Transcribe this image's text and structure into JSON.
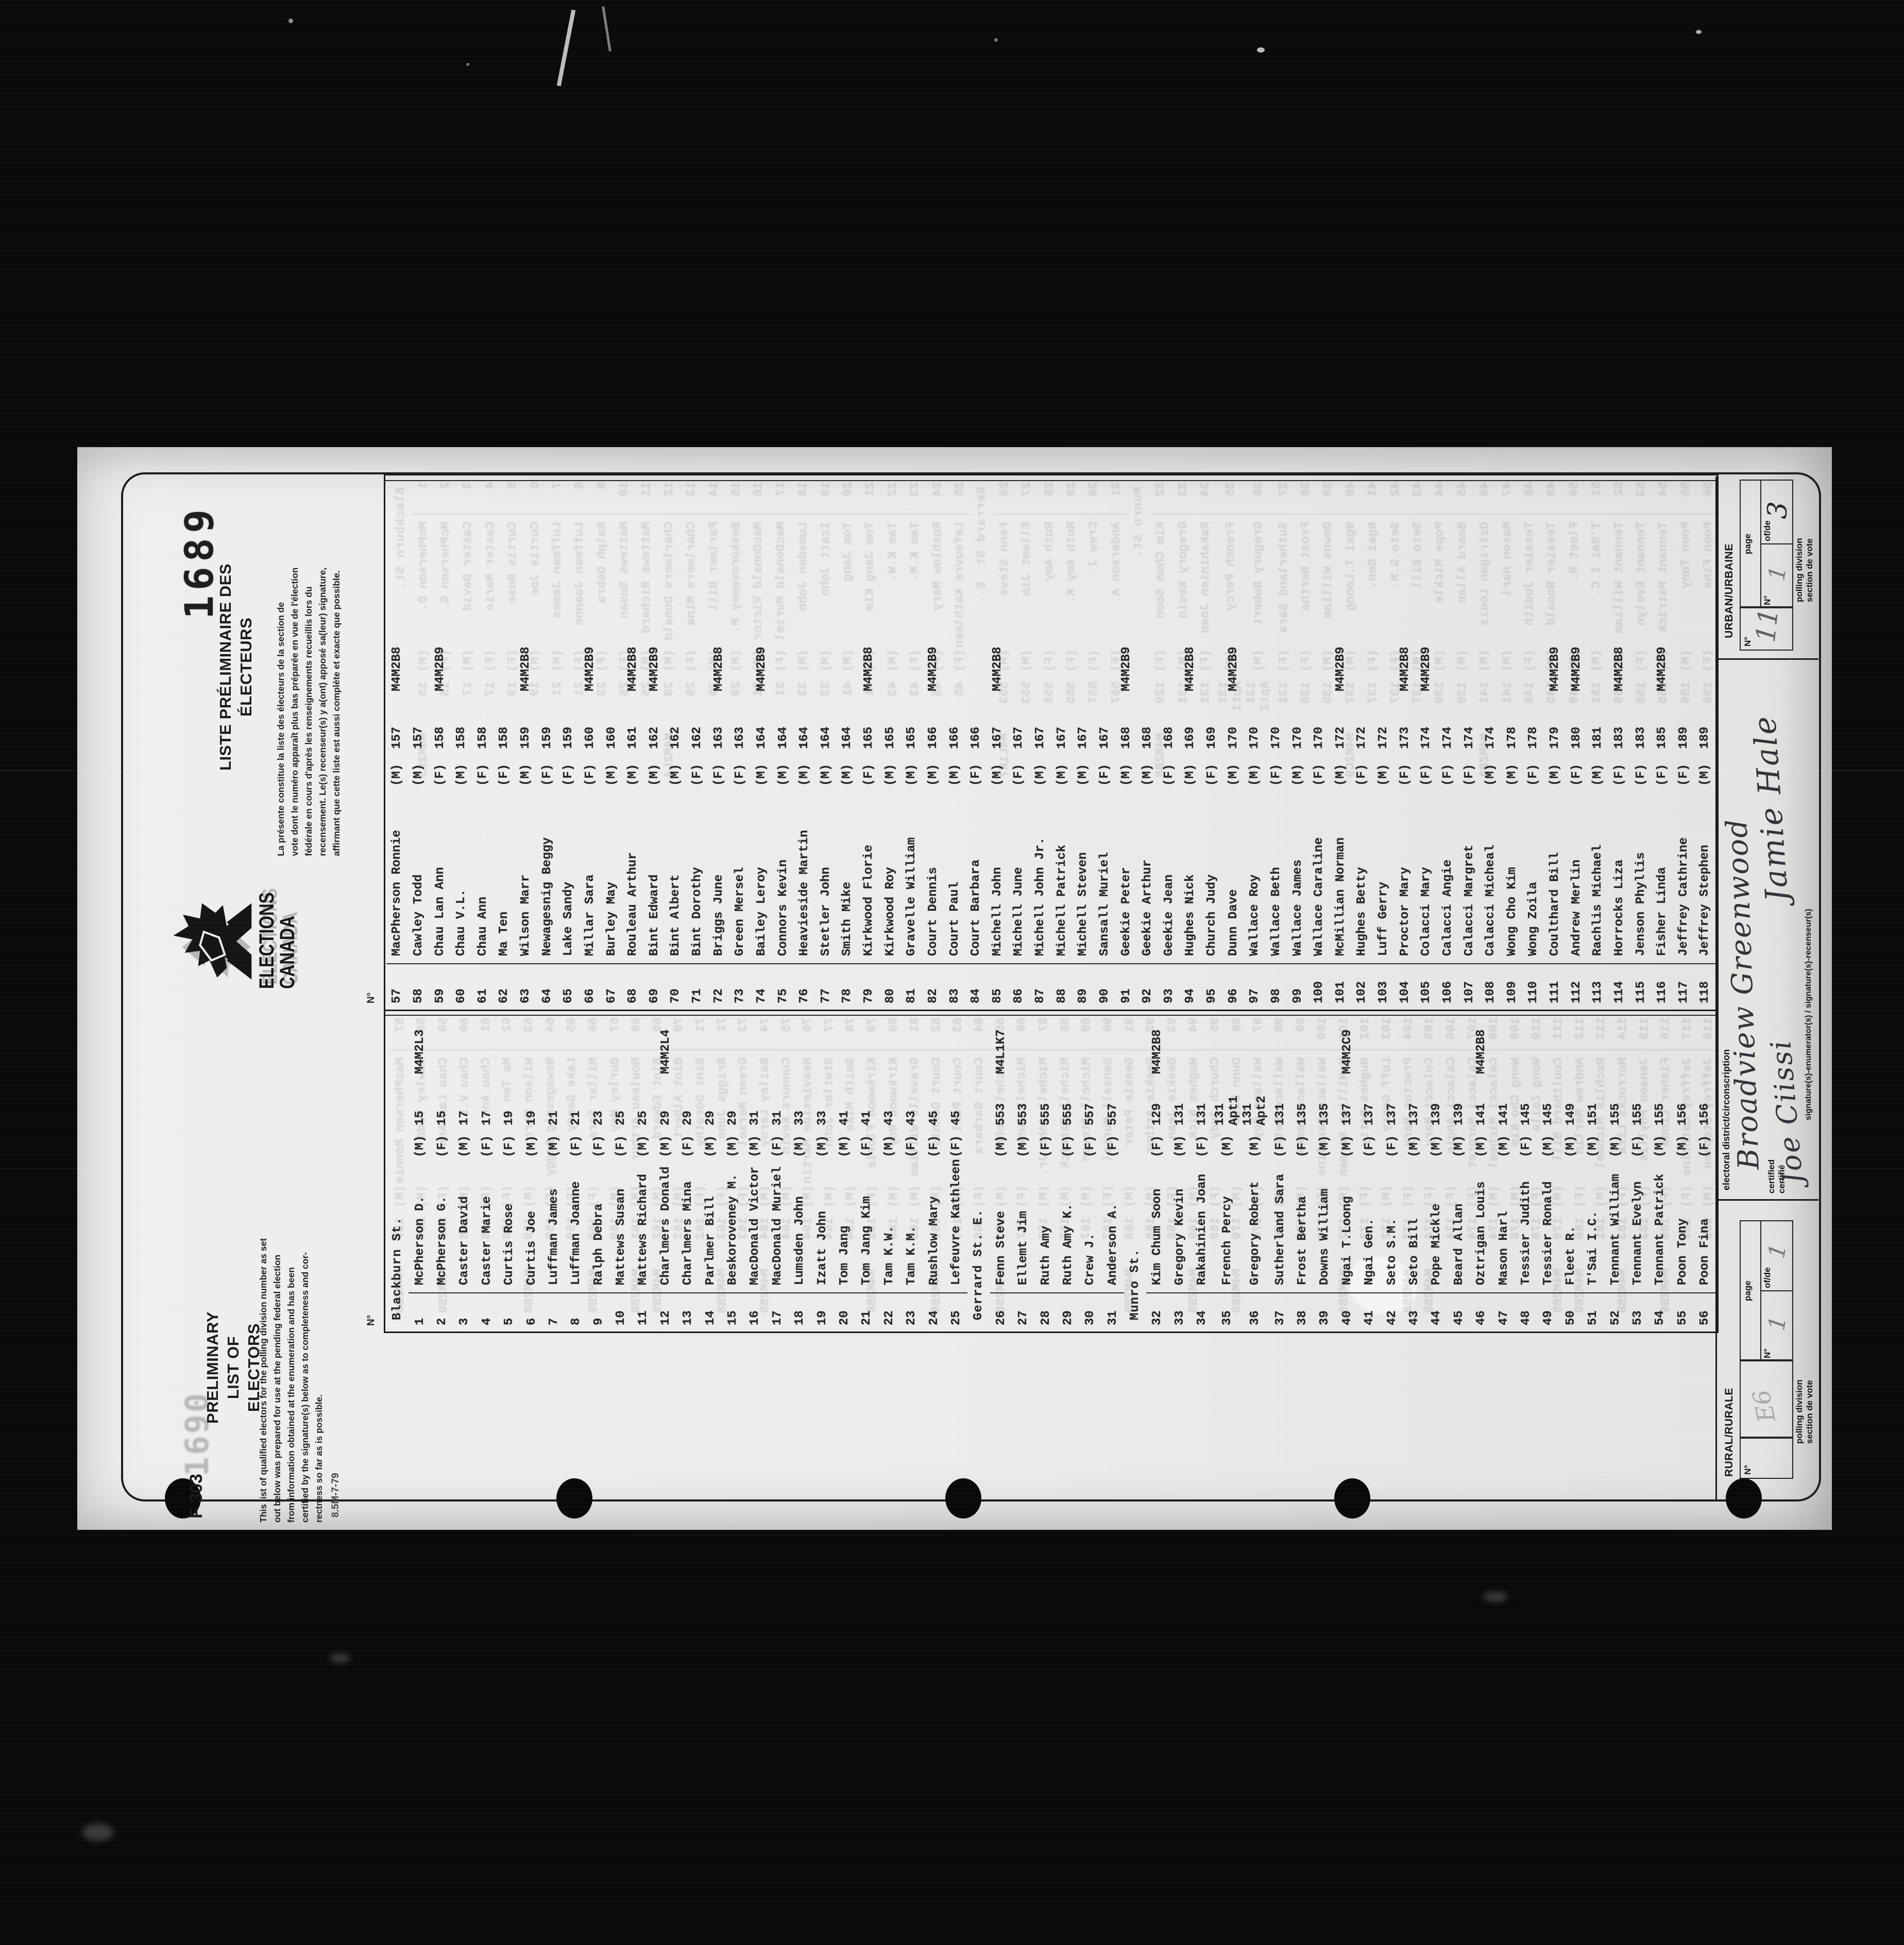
{
  "film": {
    "stamp_bold": "1689",
    "stamp_faint": "1690"
  },
  "header": {
    "form_number": "F 303",
    "print_code": "8.5M-7-79",
    "title_en_l1": "PRELIMINARY LIST OF",
    "title_en_l2": "ELECTORS",
    "paragraph_en": [
      "This list of qualified electors for the polling division number as set",
      "out below was prepared for use at the pending federal election",
      "from information obtained at the enumeration and has been",
      "certified by the signature(s) below as to completeness and cor-",
      "rectness so far as is possible."
    ],
    "logo_line1": "ELECTIONS",
    "logo_line2": "CANADA",
    "title_fr_l1": "LISTE PRÉLIMINAIRE DES",
    "title_fr_l2": "ÉLECTEURS",
    "paragraph_fr": [
      "La présente constitue la liste des électeurs de la section de",
      "vote dont le numéro apparaît plus bas préparée en vue de l'élection",
      "fédérale en cours d'après les renseignements recueillis lors du",
      "recensement. Le(s) recenseur(s) y a(ont) apposé sa(leur) signature,",
      "affirmant que cette liste est aussi complète et exacte que possible."
    ]
  },
  "table": {
    "no_header": "N°",
    "left": [
      {
        "street": "Blackburn St."
      },
      {
        "no": "1",
        "name": "McPherson D.",
        "mf": "(M)",
        "addr": "15",
        "pc": "M4M2L3"
      },
      {
        "no": "2",
        "name": "McPherson G.",
        "mf": "(F)",
        "addr": "15",
        "pc": ""
      },
      {
        "no": "3",
        "name": "Caster David",
        "mf": "(M)",
        "addr": "17",
        "pc": ""
      },
      {
        "no": "4",
        "name": "Caster Marie",
        "mf": "(F)",
        "addr": "17",
        "pc": ""
      },
      {
        "no": "5",
        "name": "Curtis Rose",
        "mf": "(F)",
        "addr": "19",
        "pc": ""
      },
      {
        "no": "6",
        "name": "Curtis Joe",
        "mf": "(M)",
        "addr": "19",
        "pc": ""
      },
      {
        "no": "7",
        "name": "Luffman James",
        "mf": "(M)",
        "addr": "21",
        "pc": ""
      },
      {
        "no": "8",
        "name": "Luffman Joanne",
        "mf": "(F)",
        "addr": "21",
        "pc": ""
      },
      {
        "no": "9",
        "name": "Ralph Debra",
        "mf": "(F)",
        "addr": "23",
        "pc": ""
      },
      {
        "no": "10",
        "name": "Mattews Susan",
        "mf": "(F)",
        "addr": "25",
        "pc": ""
      },
      {
        "no": "11",
        "name": "Mattews Richard",
        "mf": "(M)",
        "addr": "25",
        "pc": ""
      },
      {
        "no": "12",
        "name": "Charlmers Donald",
        "mf": "(M)",
        "addr": "29",
        "pc": "M4M2L4"
      },
      {
        "no": "13",
        "name": "Charlmers Mina",
        "mf": "(F)",
        "addr": "29",
        "pc": ""
      },
      {
        "no": "14",
        "name": "Parlmer Bill",
        "mf": "(M)",
        "addr": "29",
        "pc": ""
      },
      {
        "no": "15",
        "name": "Beskoroveney M.",
        "mf": "(M)",
        "addr": "29",
        "pc": ""
      },
      {
        "no": "16",
        "name": "MacDonald Victor",
        "mf": "(M)",
        "addr": "31",
        "pc": ""
      },
      {
        "no": "17",
        "name": "MacDonald Muriel",
        "mf": "(F)",
        "addr": "31",
        "pc": ""
      },
      {
        "no": "18",
        "name": "Lumsden John",
        "mf": "(M)",
        "addr": "33",
        "pc": ""
      },
      {
        "no": "19",
        "name": "Izatt John",
        "mf": "(M)",
        "addr": "33",
        "pc": ""
      },
      {
        "no": "20",
        "name": "Tom Jang",
        "mf": "(M)",
        "addr": "41",
        "pc": ""
      },
      {
        "no": "21",
        "name": "Tom Jang Kim",
        "mf": "(F)",
        "addr": "41",
        "pc": ""
      },
      {
        "no": "22",
        "name": "Tam K.W.",
        "mf": "(M)",
        "addr": "43",
        "pc": ""
      },
      {
        "no": "23",
        "name": "Tam K.M.",
        "mf": "(F)",
        "addr": "43",
        "pc": ""
      },
      {
        "no": "24",
        "name": "Rushlow Mary",
        "mf": "(F)",
        "addr": "45",
        "pc": ""
      },
      {
        "no": "25",
        "name": "Lefeuvre Kathleen",
        "mf": "(F)",
        "addr": "45",
        "pc": ""
      },
      {
        "street": "Gerrard St. E."
      },
      {
        "no": "26",
        "name": "Fenn Steve",
        "mf": "(M)",
        "addr": "553",
        "pc": "M4L1K7"
      },
      {
        "no": "27",
        "name": "Ellemt Jim",
        "mf": "(M)",
        "addr": "553",
        "pc": ""
      },
      {
        "no": "28",
        "name": "Ruth Amy",
        "mf": "(F)",
        "addr": "555",
        "pc": ""
      },
      {
        "no": "29",
        "name": "Ruth Amy K.",
        "mf": "(F)",
        "addr": "555",
        "pc": ""
      },
      {
        "no": "30",
        "name": "Crew J.",
        "mf": "(F)",
        "addr": "557",
        "pc": ""
      },
      {
        "no": "31",
        "name": "Anderson A.",
        "mf": "(F)",
        "addr": "557",
        "pc": ""
      },
      {
        "street": "Munro St."
      },
      {
        "no": "32",
        "name": "Kim Chum Soon",
        "mf": "(F)",
        "addr": "129",
        "pc": "M4M2B8"
      },
      {
        "no": "33",
        "name": "Gregory Kevin",
        "mf": "(M)",
        "addr": "131",
        "pc": ""
      },
      {
        "no": "34",
        "name": "Rakahinien Joan",
        "mf": "(F)",
        "addr": "131",
        "pc": ""
      },
      {
        "no": "35",
        "name": "French Percy",
        "mf": "(M)",
        "addr": "131 Apt1",
        "pc": ""
      },
      {
        "no": "36",
        "name": "Gregory Robert",
        "mf": "(M)",
        "addr": "131 Apt2",
        "pc": ""
      },
      {
        "no": "37",
        "name": "Sutherland Sara",
        "mf": "(F)",
        "addr": "131",
        "pc": ""
      },
      {
        "no": "38",
        "name": "Frost Bertha",
        "mf": "(F)",
        "addr": "135",
        "pc": ""
      },
      {
        "no": "39",
        "name": "Downs William",
        "mf": "(M)",
        "addr": "135",
        "pc": ""
      },
      {
        "no": "40",
        "name": "Ngai T.Loong",
        "mf": "(M)",
        "addr": "137",
        "pc": "M4M2C9"
      },
      {
        "no": "41",
        "name": "Ngai Gen.",
        "mf": "(F)",
        "addr": "137",
        "pc": ""
      },
      {
        "no": "42",
        "name": "Seto S.M.",
        "mf": "(F)",
        "addr": "137",
        "pc": ""
      },
      {
        "no": "43",
        "name": "Seto Bill",
        "mf": "(M)",
        "addr": "137",
        "pc": ""
      },
      {
        "no": "44",
        "name": "Pope Mickle",
        "mf": "(M)",
        "addr": "139",
        "pc": ""
      },
      {
        "no": "45",
        "name": "Beard Allan",
        "mf": "(M)",
        "addr": "139",
        "pc": ""
      },
      {
        "no": "46",
        "name": "Oztrigan Louis",
        "mf": "(M)",
        "addr": "141",
        "pc": "M4M2B8"
      },
      {
        "no": "47",
        "name": "Mason Harl",
        "mf": "(M)",
        "addr": "141",
        "pc": ""
      },
      {
        "no": "48",
        "name": "Tessier Judith",
        "mf": "(F)",
        "addr": "145",
        "pc": ""
      },
      {
        "no": "49",
        "name": "Tessier Ronald",
        "mf": "(M)",
        "addr": "145",
        "pc": ""
      },
      {
        "no": "50",
        "name": "Fleet R.",
        "mf": "(M)",
        "addr": "149",
        "pc": ""
      },
      {
        "no": "51",
        "name": "T'Sai I.C.",
        "mf": "(M)",
        "addr": "151",
        "pc": ""
      },
      {
        "no": "52",
        "name": "Tennant William",
        "mf": "(M)",
        "addr": "155",
        "pc": ""
      },
      {
        "no": "53",
        "name": "Tennant Evelyn",
        "mf": "(F)",
        "addr": "155",
        "pc": ""
      },
      {
        "no": "54",
        "name": "Tennant Patrick",
        "mf": "(M)",
        "addr": "155",
        "pc": ""
      },
      {
        "no": "55",
        "name": "Poon Tony",
        "mf": "(M)",
        "addr": "156",
        "pc": ""
      },
      {
        "no": "56",
        "name": "Poon Fina",
        "mf": "(F)",
        "addr": "156",
        "pc": ""
      }
    ],
    "right": [
      {
        "no": "57",
        "name": "MacPherson Ronnie",
        "mf": "(M)",
        "addr": "157",
        "pc": "M4M2B8"
      },
      {
        "no": "58",
        "name": "Cawley Todd",
        "mf": "(M)",
        "addr": "157",
        "pc": ""
      },
      {
        "no": "59",
        "name": "Chau Lan Ann",
        "mf": "(F)",
        "addr": "158",
        "pc": "M4M2B9"
      },
      {
        "no": "60",
        "name": "Chau V.L.",
        "mf": "(M)",
        "addr": "158",
        "pc": ""
      },
      {
        "no": "61",
        "name": "Chau Ann",
        "mf": "(F)",
        "addr": "158",
        "pc": ""
      },
      {
        "no": "62",
        "name": "Ma Ten",
        "mf": "(F)",
        "addr": "158",
        "pc": ""
      },
      {
        "no": "63",
        "name": "Wilson Marr",
        "mf": "(M)",
        "addr": "159",
        "pc": "M4M2B8"
      },
      {
        "no": "64",
        "name": "Newagesnig Beggy",
        "mf": "(F)",
        "addr": "159",
        "pc": ""
      },
      {
        "no": "65",
        "name": "Lake Sandy",
        "mf": "(F)",
        "addr": "159",
        "pc": ""
      },
      {
        "no": "66",
        "name": "Millar Sara",
        "mf": "(F)",
        "addr": "160",
        "pc": "M4M2B9"
      },
      {
        "no": "67",
        "name": "Burley May",
        "mf": "(M)",
        "addr": "160",
        "pc": ""
      },
      {
        "no": "68",
        "name": "Rouleau Arthur",
        "mf": "(M)",
        "addr": "161",
        "pc": "M4M2B8"
      },
      {
        "no": "69",
        "name": "Bint Edward",
        "mf": "(M)",
        "addr": "162",
        "pc": "M4M2B9"
      },
      {
        "no": "70",
        "name": "Bint Albert",
        "mf": "(M)",
        "addr": "162",
        "pc": ""
      },
      {
        "no": "71",
        "name": "Bint Dorothy",
        "mf": "(F)",
        "addr": "162",
        "pc": ""
      },
      {
        "no": "72",
        "name": "Briggs June",
        "mf": "(F)",
        "addr": "163",
        "pc": "M4M2B8"
      },
      {
        "no": "73",
        "name": "Green Mersel",
        "mf": "(F)",
        "addr": "163",
        "pc": ""
      },
      {
        "no": "74",
        "name": "Bailey Leroy",
        "mf": "(M)",
        "addr": "164",
        "pc": "M4M2B9"
      },
      {
        "no": "75",
        "name": "Connors Kevin",
        "mf": "(M)",
        "addr": "164",
        "pc": ""
      },
      {
        "no": "76",
        "name": "Heavieside Martin",
        "mf": "(M)",
        "addr": "164",
        "pc": ""
      },
      {
        "no": "77",
        "name": "Stetler John",
        "mf": "(M)",
        "addr": "164",
        "pc": ""
      },
      {
        "no": "78",
        "name": "Smith Mike",
        "mf": "(M)",
        "addr": "164",
        "pc": ""
      },
      {
        "no": "79",
        "name": "Kirkwood Florie",
        "mf": "(F)",
        "addr": "165",
        "pc": "M4M2B8"
      },
      {
        "no": "80",
        "name": "Kirkwood Roy",
        "mf": "(M)",
        "addr": "165",
        "pc": ""
      },
      {
        "no": "81",
        "name": "Gravelle William",
        "mf": "(M)",
        "addr": "165",
        "pc": ""
      },
      {
        "no": "82",
        "name": "Court Dennis",
        "mf": "(M)",
        "addr": "166",
        "pc": "M4M2B9"
      },
      {
        "no": "83",
        "name": "Court Paul",
        "mf": "(M)",
        "addr": "166",
        "pc": ""
      },
      {
        "no": "84",
        "name": "Court Barbara",
        "mf": "(F)",
        "addr": "166",
        "pc": ""
      },
      {
        "no": "85",
        "name": "Michell John",
        "mf": "(M)",
        "addr": "167",
        "pc": "M4M2B8"
      },
      {
        "no": "86",
        "name": "Michell June",
        "mf": "(F)",
        "addr": "167",
        "pc": ""
      },
      {
        "no": "87",
        "name": "Michell John Jr.",
        "mf": "(M)",
        "addr": "167",
        "pc": ""
      },
      {
        "no": "88",
        "name": "Michell Patrick",
        "mf": "(M)",
        "addr": "167",
        "pc": ""
      },
      {
        "no": "89",
        "name": "Michell Steven",
        "mf": "(M)",
        "addr": "167",
        "pc": ""
      },
      {
        "no": "90",
        "name": "Sansall Muriel",
        "mf": "(F)",
        "addr": "167",
        "pc": ""
      },
      {
        "no": "91",
        "name": "Geekie Peter",
        "mf": "(M)",
        "addr": "168",
        "pc": "M4M2B9"
      },
      {
        "no": "92",
        "name": "Geekie Arthur",
        "mf": "(M)",
        "addr": "168",
        "pc": ""
      },
      {
        "no": "93",
        "name": "Geekie Jean",
        "mf": "(F)",
        "addr": "168",
        "pc": ""
      },
      {
        "no": "94",
        "name": "Hughes Nick",
        "mf": "(M)",
        "addr": "169",
        "pc": "M4M2B8"
      },
      {
        "no": "95",
        "name": "Church Judy",
        "mf": "(F)",
        "addr": "169",
        "pc": ""
      },
      {
        "no": "96",
        "name": "Dunn Dave",
        "mf": "(M)",
        "addr": "170",
        "pc": "M4M2B9"
      },
      {
        "no": "97",
        "name": "Wallace Roy",
        "mf": "(M)",
        "addr": "170",
        "pc": ""
      },
      {
        "no": "98",
        "name": "Wallace Beth",
        "mf": "(F)",
        "addr": "170",
        "pc": ""
      },
      {
        "no": "99",
        "name": "Wallace James",
        "mf": "(M)",
        "addr": "170",
        "pc": ""
      },
      {
        "no": "100",
        "name": "Wallace Caraline",
        "mf": "(F)",
        "addr": "170",
        "pc": ""
      },
      {
        "no": "101",
        "name": "McMillian Norman",
        "mf": "(M)",
        "addr": "172",
        "pc": "M4M2B9"
      },
      {
        "no": "102",
        "name": "Hughes Betty",
        "mf": "(F)",
        "addr": "172",
        "pc": ""
      },
      {
        "no": "103",
        "name": "Luff Gerry",
        "mf": "(M)",
        "addr": "172",
        "pc": ""
      },
      {
        "no": "104",
        "name": "Proctor Mary",
        "mf": "(F)",
        "addr": "173",
        "pc": "M4M2B8"
      },
      {
        "no": "105",
        "name": "Colacci Mary",
        "mf": "(F)",
        "addr": "174",
        "pc": "M4M2B9"
      },
      {
        "no": "106",
        "name": "Calacci Angie",
        "mf": "(F)",
        "addr": "174",
        "pc": ""
      },
      {
        "no": "107",
        "name": "Calacci Margret",
        "mf": "(F)",
        "addr": "174",
        "pc": ""
      },
      {
        "no": "108",
        "name": "Calacci Micheal",
        "mf": "(M)",
        "addr": "174",
        "pc": ""
      },
      {
        "no": "109",
        "name": "Wong Cho Kim",
        "mf": "(M)",
        "addr": "178",
        "pc": ""
      },
      {
        "no": "110",
        "name": "Wong Zoila",
        "mf": "(F)",
        "addr": "178",
        "pc": ""
      },
      {
        "no": "111",
        "name": "Coulthard Bill",
        "mf": "(M)",
        "addr": "179",
        "pc": "M4M2B9"
      },
      {
        "no": "112",
        "name": "Andrew Merlin",
        "mf": "(F)",
        "addr": "180",
        "pc": "M4M2B9"
      },
      {
        "no": "113",
        "name": "Rachlis Michael",
        "mf": "(M)",
        "addr": "181",
        "pc": ""
      },
      {
        "no": "114",
        "name": "Horrocks Liza",
        "mf": "(F)",
        "addr": "183",
        "pc": "M4M2B8"
      },
      {
        "no": "115",
        "name": "Jenson Phyllis",
        "mf": "(F)",
        "addr": "183",
        "pc": ""
      },
      {
        "no": "116",
        "name": "Fisher Linda",
        "mf": "(F)",
        "addr": "185",
        "pc": "M4M2B9"
      },
      {
        "no": "117",
        "name": "Jeffrey Cathrine",
        "mf": "(F)",
        "addr": "189",
        "pc": ""
      },
      {
        "no": "118",
        "name": "Jeffrey Stephen",
        "mf": "(M)",
        "addr": "189",
        "pc": ""
      }
    ]
  },
  "footer": {
    "rural": {
      "label": "RURAL/RURALE",
      "no_label": "N°",
      "no_value": "E6",
      "page_label": "page",
      "page_no_label": "N°",
      "page_no_value": "1",
      "ofde_label": "of/de",
      "ofde_value": "1",
      "polling_l1": "polling division",
      "polling_l2": "section de vote"
    },
    "middle": {
      "district_label": "electoral district/circonscription",
      "district_value": "Broadview Greenwood",
      "certified_l1": "certified",
      "certified_l2": "certifié",
      "signature_label": "signature(s)-enumerator(s) / signature(s)-recenseur(s)",
      "signature1": "Joe Ciissi",
      "signature2": "Jamie Hale"
    },
    "urban": {
      "label": "URBAN/URBAINE",
      "no_label": "N°",
      "no_value": "11",
      "page_label": "page",
      "page_no_label": "N°",
      "page_no_value": "1",
      "ofde_label": "of/de",
      "ofde_value": "3",
      "polling_l1": "polling division",
      "polling_l2": "section de vote"
    }
  }
}
